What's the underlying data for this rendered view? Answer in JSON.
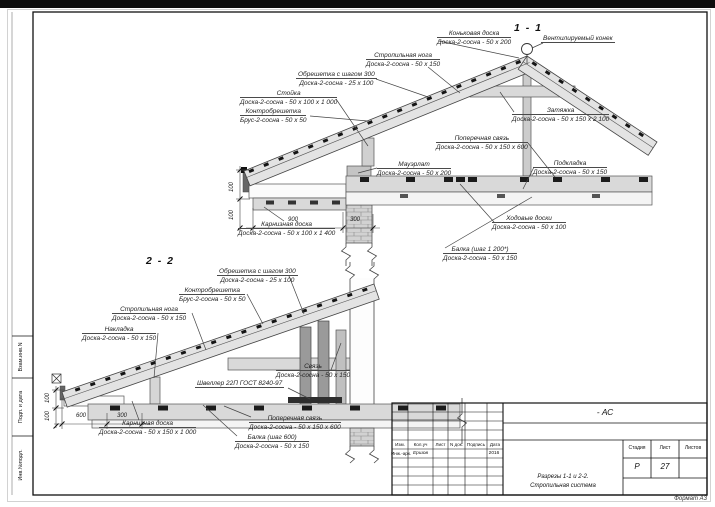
{
  "drawing": {
    "sections": [
      {
        "title": "1 - 1",
        "callouts": [
          {
            "name": "Коньковая доска",
            "spec": "Доска-2-сосна - 50 х 200"
          },
          {
            "name": "Вентилируемый конек",
            "spec": ""
          },
          {
            "name": "Стропильная нога",
            "spec": "Доска-2-сосна - 50 х 150"
          },
          {
            "name": "Обрешетка с шагом 300",
            "spec": "Доска-2-сосна - 25 х 100"
          },
          {
            "name": "Стойка",
            "spec": "Доска-2-сосна - 50 х 100 х 1 000"
          },
          {
            "name": "Контробрешетка",
            "spec": "Брус-2-сосна - 50 х 50"
          },
          {
            "name": "Мауэрлат",
            "spec": "Доска-2-сосна - 50 х 200"
          },
          {
            "name": "Затяжка",
            "spec": "Доска-2-сосна - 50 х 150 х 2 100"
          },
          {
            "name": "Поперечная связь",
            "spec": "Доска-2-сосна - 50 х 150 х 600"
          },
          {
            "name": "Подкладка",
            "spec": "Доска-2-сосна - 50 х 150"
          },
          {
            "name": "Ходовые доски",
            "spec": "Доска-2-сосна - 50 х 100"
          },
          {
            "name": "Карнизная доска",
            "spec": "Доска-2-сосна - 50 х 100 х 1 400"
          },
          {
            "name": "Балка (шаг 1 200*)",
            "spec": "Доска-2-сосна - 50 х 150"
          }
        ],
        "dims": {
          "h1": "900",
          "h2": "300",
          "v1": "100",
          "v2": "100"
        }
      },
      {
        "title": "2 - 2",
        "callouts": [
          {
            "name": "Обрешетка с шагом 300",
            "spec": "Доска-2-сосна - 25 х 100"
          },
          {
            "name": "Контробрешетка",
            "spec": "Брус-2-сосна - 50 х 50"
          },
          {
            "name": "Стропильная нога",
            "spec": "Доска-2-сосна - 50 х 150"
          },
          {
            "name": "Накладка",
            "spec": "Доска-2-сосна - 50 х 150"
          },
          {
            "name": "Швеллер 22П ГОСТ 8240-97",
            "spec": ""
          },
          {
            "name": "Связь",
            "spec": "Доска-2-сосна - 50 х 150"
          },
          {
            "name": "Поперечная связь",
            "spec": "Доска-2-сосна - 50 х 150 х 600"
          },
          {
            "name": "Карнизная доска",
            "spec": "Доска-2-сосна - 50 х 150 х 1 000"
          },
          {
            "name": "Балка (шаг 600)",
            "spec": "Доска-2-сосна - 50 х 150"
          }
        ],
        "dims": {
          "h1": "600",
          "h2": "300",
          "v1": "100",
          "v2": "100"
        }
      }
    ]
  },
  "frame": {
    "side_labels": [
      {
        "label": "Взам.инв.N"
      },
      {
        "label": "Подп. и дата"
      },
      {
        "label": "Инв.№подл."
      }
    ],
    "format_label": "Формат А3"
  },
  "title_block": {
    "code": "- АС",
    "doc_title_line1": "Разрезы 1-1 и 2-2.",
    "doc_title_line2": "Стропильная система",
    "columns": {
      "izm": "Изм.",
      "kol": "Кол.уч",
      "list": "Лист",
      "ndok": "N док.",
      "podpis": "Подпись",
      "data": "Дата"
    },
    "signer_role": "Инж.-арх.",
    "signer_name": "Ершов",
    "signer_date": "2016",
    "stage_label": "Стадия",
    "sheet_label": "Лист",
    "sheets_label": "Листов",
    "stage_value": "Р",
    "sheet_value": "27"
  }
}
